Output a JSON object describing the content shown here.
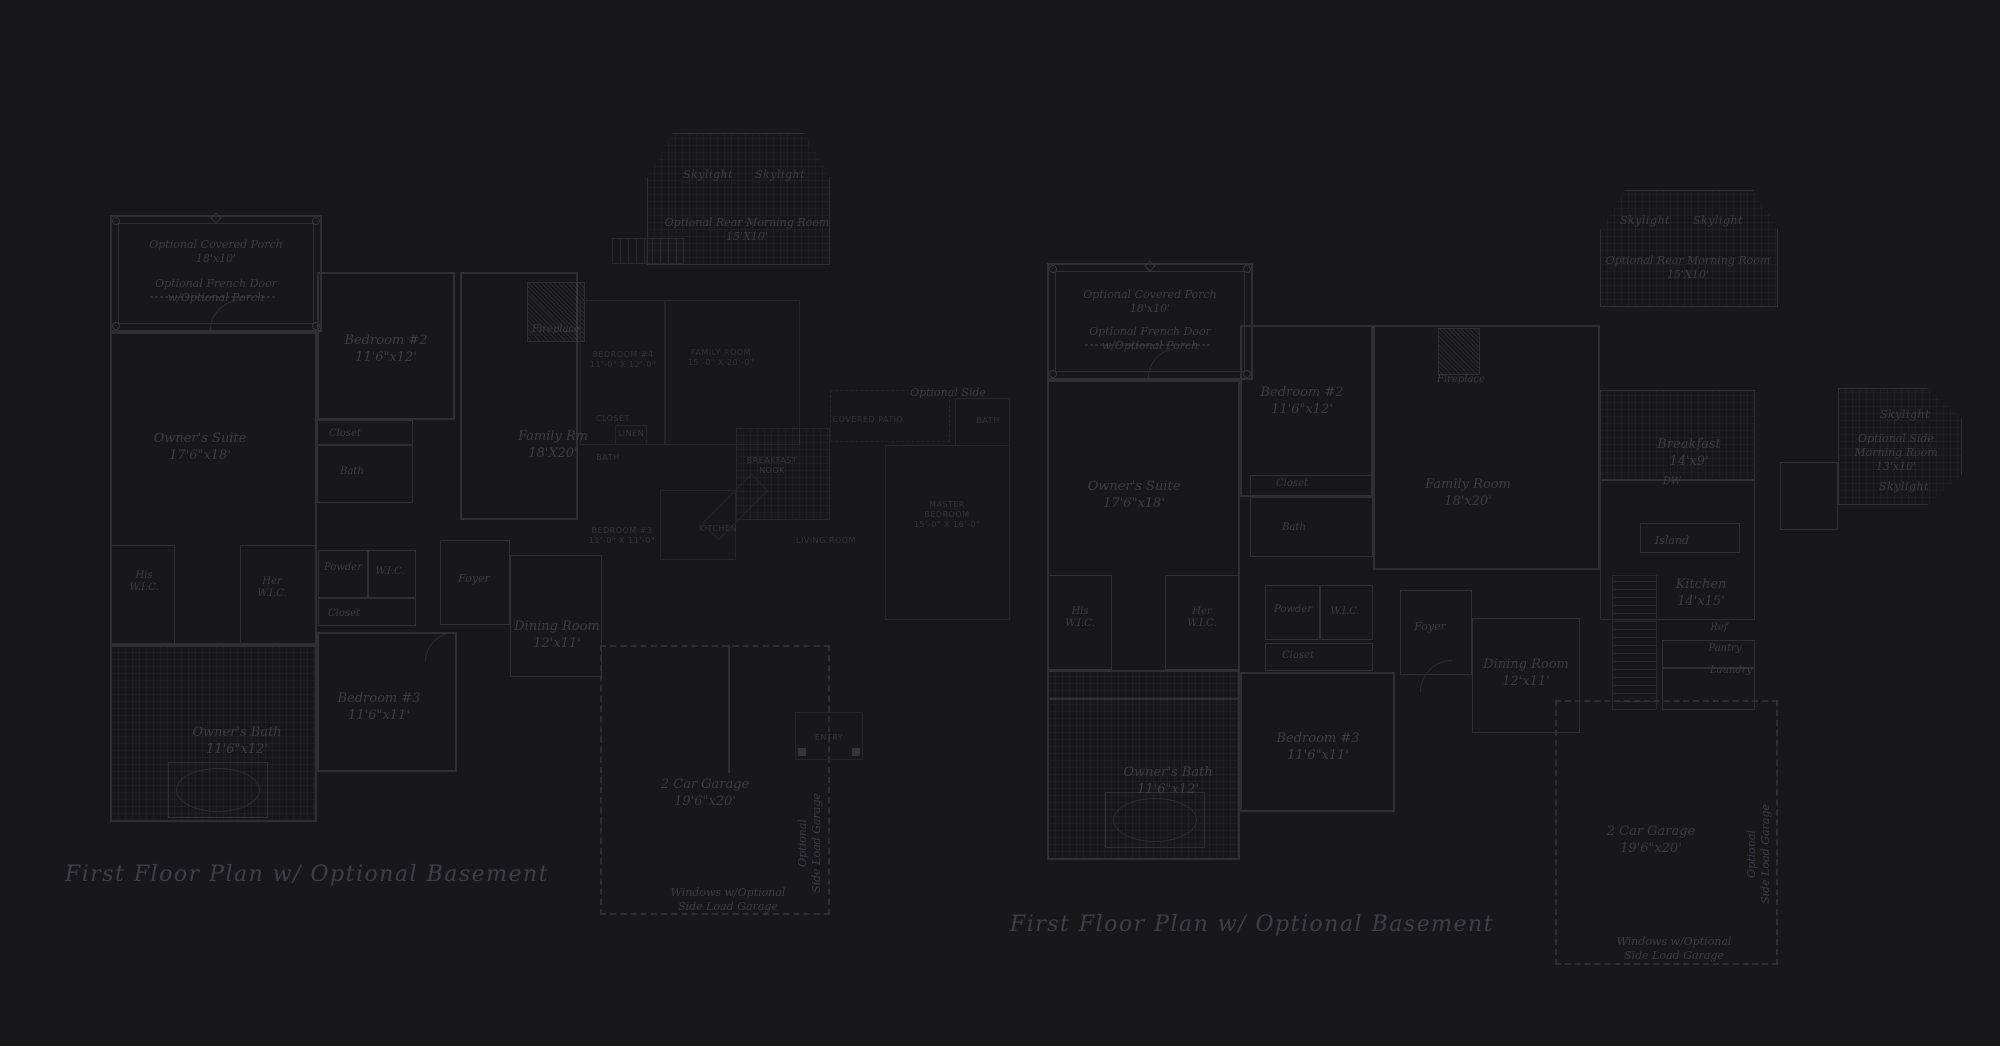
{
  "title": "First floor plan drawings",
  "colors": {
    "background": "#18171a",
    "wall_line": "#302f34",
    "faint_line": "#26262a",
    "label_text": "#3d3d45",
    "caps_text": "#34343b",
    "caption_text": "#403f49"
  },
  "plans": [
    {
      "id": "left-plan",
      "caption": "First Floor Plan  w/ Optional Basement",
      "labels": [
        {
          "name": "optional-covered-porch-label",
          "x": 216,
          "y": 238,
          "cls": "mid",
          "lines": [
            "Optional Covered Porch",
            "18'x10'"
          ]
        },
        {
          "name": "optional-french-door-label",
          "x": 216,
          "y": 277,
          "cls": "mid",
          "lines": [
            "Optional French Door",
            "w/Optional Porch"
          ]
        },
        {
          "name": "skylight-label-1",
          "x": 708,
          "y": 168,
          "cls": "sky",
          "lines": [
            "Skylight"
          ]
        },
        {
          "name": "skylight-label-2",
          "x": 780,
          "y": 168,
          "cls": "sky",
          "lines": [
            "Skylight"
          ]
        },
        {
          "name": "rear-morning-room-label",
          "x": 747,
          "y": 216,
          "cls": "mid",
          "lines": [
            "Optional Rear Morning Room",
            "15'X10'"
          ]
        },
        {
          "name": "bedroom2-label",
          "x": 386,
          "y": 332,
          "cls": "room",
          "lines": [
            "Bedroom #2",
            "11'6\"x12'"
          ]
        },
        {
          "name": "closet-label",
          "x": 345,
          "y": 428,
          "cls": "small",
          "lines": [
            "Closet"
          ]
        },
        {
          "name": "bath-label",
          "x": 352,
          "y": 466,
          "cls": "small",
          "lines": [
            "Bath"
          ]
        },
        {
          "name": "owners-suite-label",
          "x": 200,
          "y": 430,
          "cls": "room",
          "lines": [
            "Owner's Suite",
            "17'6\"x18'"
          ]
        },
        {
          "name": "fireplace-label",
          "x": 556,
          "y": 324,
          "cls": "small",
          "lines": [
            "Fireplace"
          ]
        },
        {
          "name": "family-rm-label",
          "x": 553,
          "y": 428,
          "cls": "room",
          "lines": [
            "Family Rm",
            "18'X20'"
          ]
        },
        {
          "name": "his-wic-label",
          "x": 144,
          "y": 570,
          "cls": "small",
          "lines": [
            "His",
            "W.I.C."
          ]
        },
        {
          "name": "her-wic-label",
          "x": 272,
          "y": 576,
          "cls": "small",
          "lines": [
            "Her",
            "W.I.C."
          ]
        },
        {
          "name": "powder-label",
          "x": 343,
          "y": 562,
          "cls": "small",
          "lines": [
            "Powder"
          ]
        },
        {
          "name": "wic-label",
          "x": 390,
          "y": 566,
          "cls": "small",
          "lines": [
            "W.I.C."
          ]
        },
        {
          "name": "closet2-label",
          "x": 344,
          "y": 608,
          "cls": "small",
          "lines": [
            "Closet"
          ]
        },
        {
          "name": "foyer-label",
          "x": 474,
          "y": 572,
          "cls": "mid",
          "lines": [
            "Foyer"
          ]
        },
        {
          "name": "dining-room-label",
          "x": 557,
          "y": 618,
          "cls": "room",
          "lines": [
            "Dining Room",
            "12'x11'"
          ]
        },
        {
          "name": "optional-side-label",
          "x": 948,
          "y": 386,
          "cls": "mid",
          "lines": [
            "Optional Side"
          ]
        },
        {
          "name": "bedroom3-label",
          "x": 379,
          "y": 690,
          "cls": "room",
          "lines": [
            "Bedroom #3",
            "11'6\"x11'"
          ]
        },
        {
          "name": "owners-bath-label",
          "x": 237,
          "y": 724,
          "cls": "room",
          "lines": [
            "Owner's Bath",
            "11'6\"x12'"
          ]
        },
        {
          "name": "garage-label",
          "x": 705,
          "y": 776,
          "cls": "room",
          "lines": [
            "2 Car Garage",
            "19'6\"x20'"
          ]
        },
        {
          "name": "side-load-garage-vertical-label",
          "x": 810,
          "y": 843,
          "cls": "mid vert",
          "lines": [
            "Optional",
            "Side Load Garage"
          ]
        },
        {
          "name": "windows-optional-label",
          "x": 728,
          "y": 886,
          "cls": "mid",
          "lines": [
            "Windows w/Optional",
            "Side Load Garage"
          ]
        },
        {
          "name": "caps-bedroom4-label",
          "x": 623,
          "y": 350,
          "cls": "caps",
          "lines": [
            "BEDROOM #4",
            "11'-0\" X 12'-0\""
          ]
        },
        {
          "name": "caps-family-room-label",
          "x": 721,
          "y": 348,
          "cls": "caps",
          "lines": [
            "FAMILY ROOM",
            "15'-0\" X 20'-0\""
          ]
        },
        {
          "name": "caps-closet-label",
          "x": 613,
          "y": 414,
          "cls": "caps",
          "lines": [
            "CLOSET"
          ]
        },
        {
          "name": "caps-linen-label",
          "x": 631,
          "y": 429,
          "cls": "caps",
          "lines": [
            "LINEN"
          ]
        },
        {
          "name": "caps-bath-label",
          "x": 608,
          "y": 453,
          "cls": "caps",
          "lines": [
            "BATH"
          ]
        },
        {
          "name": "caps-breakfast-nook-label",
          "x": 772,
          "y": 456,
          "cls": "caps",
          "lines": [
            "BREAKFAST",
            "NOOK"
          ]
        },
        {
          "name": "caps-kitchen-label",
          "x": 718,
          "y": 524,
          "cls": "caps",
          "lines": [
            "KITCHEN"
          ]
        },
        {
          "name": "caps-bedroom3-label",
          "x": 622,
          "y": 526,
          "cls": "caps",
          "lines": [
            "BEDROOM #3",
            "11'-0\" X 11'-0\""
          ]
        },
        {
          "name": "caps-living-room-label",
          "x": 826,
          "y": 536,
          "cls": "caps",
          "lines": [
            "LIVING ROOM"
          ]
        },
        {
          "name": "caps-master-bedroom-label",
          "x": 947,
          "y": 500,
          "cls": "caps",
          "lines": [
            "MASTER",
            "BEDROOM",
            "15'-0\" X 16'-0\""
          ]
        },
        {
          "name": "caps-covered-patio-label",
          "x": 868,
          "y": 415,
          "cls": "caps",
          "lines": [
            "COVERED PATIO"
          ]
        },
        {
          "name": "caps-bath2-label",
          "x": 988,
          "y": 416,
          "cls": "caps",
          "lines": [
            "BATH"
          ]
        },
        {
          "name": "caps-entry-label",
          "x": 829,
          "y": 733,
          "cls": "caps",
          "lines": [
            "ENTRY"
          ]
        }
      ]
    },
    {
      "id": "right-plan",
      "caption": "First Floor Plan  w/ Optional Basement",
      "labels": [
        {
          "name": "optional-covered-porch-label",
          "x": 1150,
          "y": 288,
          "cls": "mid",
          "lines": [
            "Optional Covered Porch",
            "18'x10'"
          ]
        },
        {
          "name": "optional-french-door-label",
          "x": 1150,
          "y": 325,
          "cls": "mid",
          "lines": [
            "Optional French Door",
            "w/Optional Porch"
          ]
        },
        {
          "name": "skylight-label-1",
          "x": 1645,
          "y": 214,
          "cls": "sky",
          "lines": [
            "Skylight"
          ]
        },
        {
          "name": "skylight-label-2",
          "x": 1718,
          "y": 214,
          "cls": "sky",
          "lines": [
            "Skylight"
          ]
        },
        {
          "name": "rear-morning-room-label",
          "x": 1688,
          "y": 254,
          "cls": "mid",
          "lines": [
            "Optional Rear Morning Room",
            "15'X10'"
          ]
        },
        {
          "name": "bedroom2-label",
          "x": 1302,
          "y": 384,
          "cls": "room",
          "lines": [
            "Bedroom #2",
            "11'6\"x12'"
          ]
        },
        {
          "name": "closet-label",
          "x": 1292,
          "y": 478,
          "cls": "small",
          "lines": [
            "Closet"
          ]
        },
        {
          "name": "bath-label",
          "x": 1294,
          "y": 522,
          "cls": "small",
          "lines": [
            "Bath"
          ]
        },
        {
          "name": "owners-suite-label",
          "x": 1134,
          "y": 478,
          "cls": "room",
          "lines": [
            "Owner's Suite",
            "17'6\"x18'"
          ]
        },
        {
          "name": "fireplace-label",
          "x": 1461,
          "y": 374,
          "cls": "small",
          "lines": [
            "Fireplace"
          ]
        },
        {
          "name": "family-room-label",
          "x": 1468,
          "y": 476,
          "cls": "room",
          "lines": [
            "Family Room",
            "18'x20'"
          ]
        },
        {
          "name": "breakfast-label",
          "x": 1689,
          "y": 436,
          "cls": "room",
          "lines": [
            "Breakfast",
            "14'x9'"
          ]
        },
        {
          "name": "dw-label",
          "x": 1672,
          "y": 476,
          "cls": "small",
          "lines": [
            "DW"
          ]
        },
        {
          "name": "island-label",
          "x": 1672,
          "y": 534,
          "cls": "mid",
          "lines": [
            "Island"
          ]
        },
        {
          "name": "kitchen-label",
          "x": 1701,
          "y": 576,
          "cls": "room",
          "lines": [
            "Kitchen",
            "14'x15'"
          ]
        },
        {
          "name": "ref-label",
          "x": 1719,
          "y": 622,
          "cls": "small",
          "lines": [
            "Ref"
          ]
        },
        {
          "name": "pantry-label",
          "x": 1725,
          "y": 643,
          "cls": "small",
          "lines": [
            "Pantry"
          ]
        },
        {
          "name": "laundry-label",
          "x": 1731,
          "y": 665,
          "cls": "small",
          "lines": [
            "Laundry"
          ]
        },
        {
          "name": "side-skylight-label-1",
          "x": 1905,
          "y": 408,
          "cls": "sky",
          "lines": [
            "Skylight"
          ]
        },
        {
          "name": "side-morning-room-label",
          "x": 1896,
          "y": 432,
          "cls": "mid",
          "lines": [
            "Optional Side",
            "Morning Room",
            "13'x10'"
          ]
        },
        {
          "name": "side-skylight-label-2",
          "x": 1904,
          "y": 480,
          "cls": "sky",
          "lines": [
            "Skylight"
          ]
        },
        {
          "name": "his-wic-label",
          "x": 1080,
          "y": 606,
          "cls": "small",
          "lines": [
            "His",
            "W.I.C."
          ]
        },
        {
          "name": "her-wic-label",
          "x": 1202,
          "y": 606,
          "cls": "small",
          "lines": [
            "Her",
            "W.I.C."
          ]
        },
        {
          "name": "powder-label",
          "x": 1293,
          "y": 604,
          "cls": "small",
          "lines": [
            "Powder"
          ]
        },
        {
          "name": "wic-label",
          "x": 1345,
          "y": 606,
          "cls": "small",
          "lines": [
            "W.I.C."
          ]
        },
        {
          "name": "closet2-label",
          "x": 1298,
          "y": 650,
          "cls": "small",
          "lines": [
            "Closet"
          ]
        },
        {
          "name": "foyer-label",
          "x": 1430,
          "y": 620,
          "cls": "mid",
          "lines": [
            "Foyer"
          ]
        },
        {
          "name": "dining-room-label",
          "x": 1526,
          "y": 656,
          "cls": "room",
          "lines": [
            "Dining Room",
            "12'x11'"
          ]
        },
        {
          "name": "bedroom3-label",
          "x": 1318,
          "y": 730,
          "cls": "room",
          "lines": [
            "Bedroom #3",
            "11'6\"x11'"
          ]
        },
        {
          "name": "owners-bath-label",
          "x": 1168,
          "y": 764,
          "cls": "room",
          "lines": [
            "Owner's Bath",
            "11'6\"x12'"
          ]
        },
        {
          "name": "garage-label",
          "x": 1651,
          "y": 823,
          "cls": "room",
          "lines": [
            "2 Car Garage",
            "19'6\"x20'"
          ]
        },
        {
          "name": "side-load-garage-vertical-label",
          "x": 1759,
          "y": 854,
          "cls": "mid vert",
          "lines": [
            "Optional",
            "Side Load Garage"
          ]
        },
        {
          "name": "windows-optional-label",
          "x": 1674,
          "y": 935,
          "cls": "mid",
          "lines": [
            "Windows w/Optional",
            "Side Load Garage"
          ]
        }
      ]
    }
  ],
  "captions": [
    {
      "name": "left-plan-caption",
      "x": 307,
      "y": 862,
      "text": "First Floor Plan  w/ Optional Basement"
    },
    {
      "name": "right-plan-caption",
      "x": 1252,
      "y": 912,
      "text": "First Floor Plan  w/ Optional Basement"
    }
  ]
}
